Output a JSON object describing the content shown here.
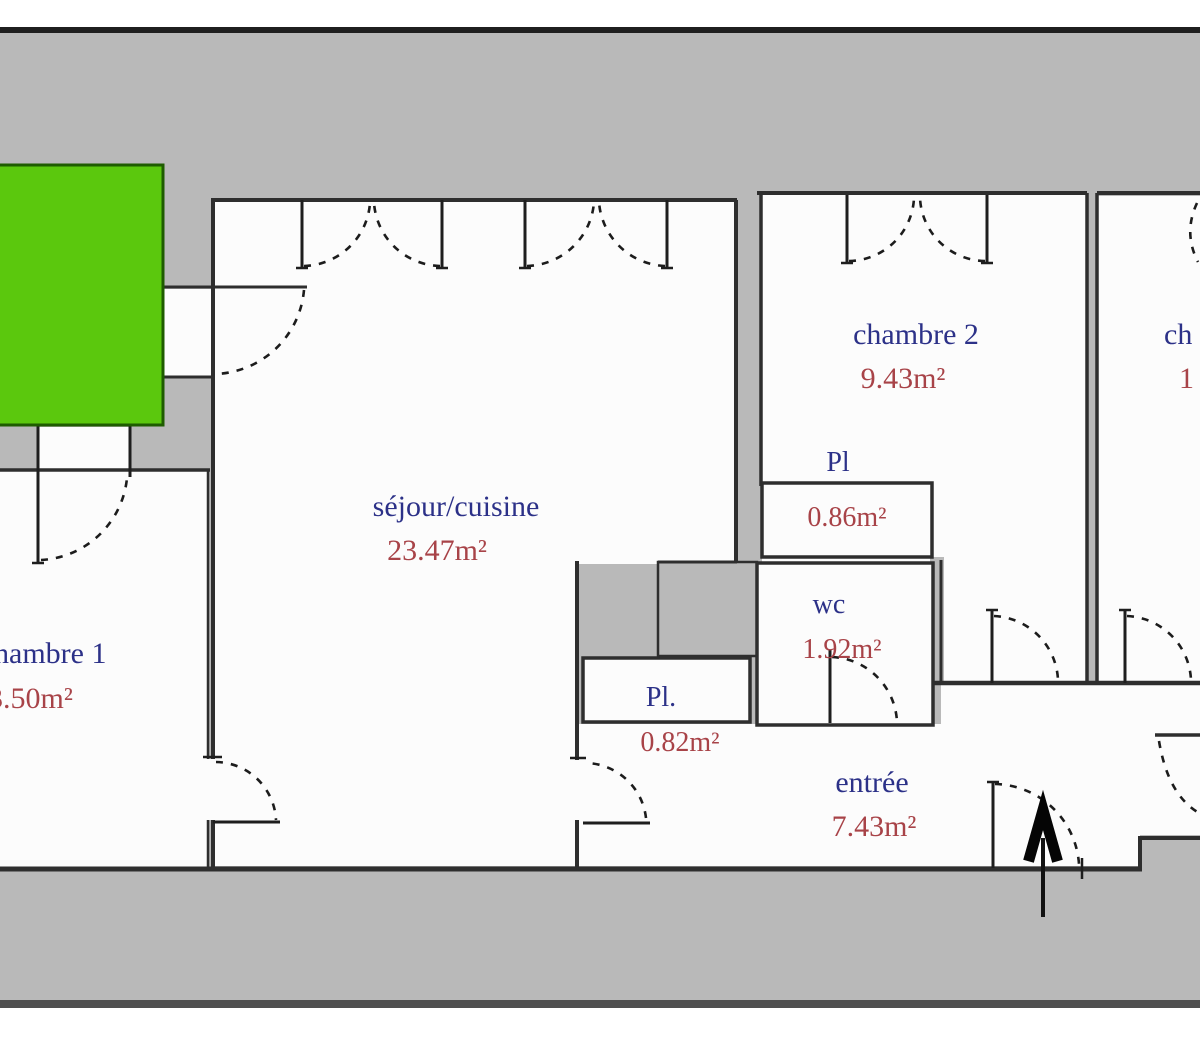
{
  "plan": {
    "title": "apartment-floor-plan",
    "rooms": [
      {
        "id": "chambre1",
        "label": "hambre 1",
        "area": "3.50m²"
      },
      {
        "id": "sejour",
        "label": "séjour/cuisine",
        "area": "23.47m²"
      },
      {
        "id": "chambre2",
        "label": "chambre 2",
        "area": "9.43m²"
      },
      {
        "id": "chambre3",
        "label": "ch",
        "area": "1"
      },
      {
        "id": "placard-haut",
        "label": "Pl",
        "area": "0.86m²"
      },
      {
        "id": "wc",
        "label": "wc",
        "area": "1.92m²"
      },
      {
        "id": "placard-bas",
        "label": "Pl.",
        "area": "0.82m²"
      },
      {
        "id": "entree",
        "label": "entrée",
        "area": "7.43m²"
      }
    ],
    "colors": {
      "room_label_blue": "#2c3188",
      "area_label_red": "#a84348",
      "balcony_green": "#5bc80d",
      "balcony_border": "#1e5c00",
      "background_gray": "#b9b9b9",
      "wall_dark": "#2e2e2e",
      "top_bar": "#1f1f1f",
      "bottom_bar": "#4f4f4f",
      "room_white": "#fcfcfc"
    },
    "icons": {
      "entrance_arrow": "north-entrance-arrow"
    }
  }
}
